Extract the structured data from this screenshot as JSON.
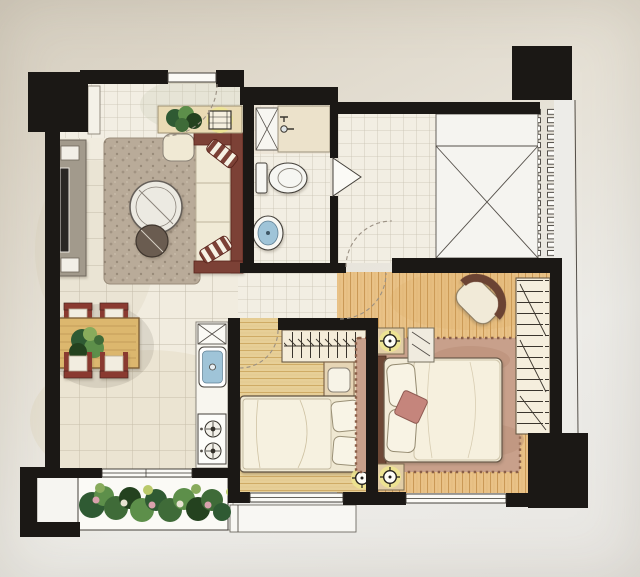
{
  "image": {
    "kind": "hand-drawn watercolor apartment floor plan, top-down photo of a printed rendering",
    "visible_text": "none",
    "legend": {
      "walls": "thick solid black",
      "doors": "dashed quarter-circle swing arcs",
      "windows": "double-line gaps in walls",
      "lamps": "crosshair circles with yellow glow",
      "void_area": "square crossed with X diagonals",
      "louver": "vertical row of small rectangles"
    }
  },
  "palette": {
    "wall": "#1b1815",
    "paper": "#e3ddd1",
    "tile": "#f1ecdf",
    "tile-line": "#aaa18f",
    "wood2": "#e7cf97",
    "wood2-stripe": "#c9a258",
    "woodm": "#e9c287",
    "woodm-stripe": "#c28f4a",
    "maroon": "#7c4136",
    "maroon-dark": "#59241c",
    "cream": "#f0ead6",
    "rug-living": "#b9ab99",
    "rug-master": "#c8a08b",
    "water": "#9fc4d8",
    "glow": "#eee68f",
    "table-wood": "#dcb76e",
    "counter": "#f8f6ef",
    "leaf-dark": "#2f5a33",
    "leaf-mid": "#5d8f4a",
    "leaf-light": "#88ab5c",
    "flower-pink": "#d9a1ad"
  },
  "rooms": [
    {
      "id": "foyer",
      "features": [
        "entry-door",
        "entry-swing-arc",
        "shoe-cabinet",
        "console-shelf",
        "console-plant",
        "decor-tray"
      ]
    },
    {
      "id": "living-room",
      "features": [
        "tv-console",
        "tv",
        "area-rug",
        "round-glass-coffee-table",
        "round-side-stool",
        "ottoman",
        "three-seat-sofa",
        "striped-throw-pillows"
      ]
    },
    {
      "id": "dining-area",
      "features": [
        "wood-dining-table",
        "table-plant",
        "chair x4 with maroon frames"
      ]
    },
    {
      "id": "kitchen",
      "features": [
        "counter-strip",
        "refrigerator-space-x",
        "sink-with-faucet",
        "two-burner-stove"
      ]
    },
    {
      "id": "bathroom",
      "features": [
        "shower-stall-x",
        "vanity-counter",
        "faucet",
        "toilet",
        "round-basin",
        "swing-door"
      ]
    },
    {
      "id": "laundry-room",
      "features": [
        "small-tile-floor",
        "door-swing-arc"
      ]
    },
    {
      "id": "utility-platform",
      "features": [
        "x-marked-void",
        "louver-grille",
        "outer-ledge-line"
      ]
    },
    {
      "id": "hallway",
      "features": [
        "small-tile-floor",
        "bedroom-door-arcs"
      ]
    },
    {
      "id": "bedroom-2",
      "features": [
        "wardrobe-with-hangers",
        "desk-nook",
        "desk-chair",
        "single-bed",
        "pillows x2",
        "ceiling-lamp",
        "window",
        "small-balcony-ledge"
      ]
    },
    {
      "id": "master-bedroom",
      "features": [
        "double-bed",
        "headboard",
        "pillows x2",
        "pink-throw-pillow",
        "fringed-area-rug",
        "nightstand x2",
        "ceiling-lamp x2",
        "tv-cabinet",
        "corner-armchair",
        "wardrobe-rungs",
        "window"
      ]
    },
    {
      "id": "balcony",
      "features": [
        "planter-box",
        "plants-and-flowers",
        "sliding-door"
      ]
    }
  ]
}
